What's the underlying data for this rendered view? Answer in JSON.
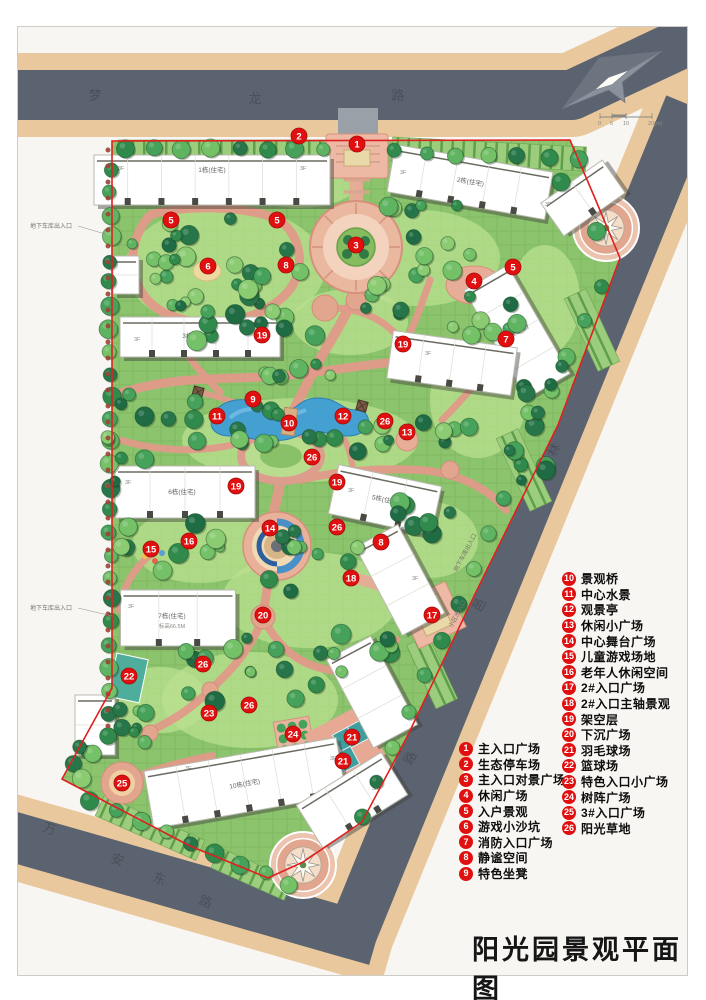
{
  "title": "阳光园景观平面图",
  "roads": [
    {
      "id": "menglong",
      "name": "梦龙路"
    },
    {
      "id": "linyi",
      "name": "林邑路"
    },
    {
      "id": "wanandong",
      "name": "万安东路"
    }
  ],
  "scale_bar": {
    "labels": [
      "0",
      "5",
      "10",
      "20(m)"
    ]
  },
  "legend": {
    "group_left": [
      {
        "num": "1",
        "label": "主入口广场"
      },
      {
        "num": "2",
        "label": "生态停车场"
      },
      {
        "num": "3",
        "label": "主入口对景广场"
      },
      {
        "num": "4",
        "label": "休闲广场"
      },
      {
        "num": "5",
        "label": "入户景观"
      },
      {
        "num": "6",
        "label": "游戏小沙坑"
      },
      {
        "num": "7",
        "label": "消防入口广场"
      },
      {
        "num": "8",
        "label": "静谧空间"
      },
      {
        "num": "9",
        "label": "特色坐凳"
      }
    ],
    "group_right": [
      {
        "num": "10",
        "label": "景观桥"
      },
      {
        "num": "11",
        "label": "中心水景"
      },
      {
        "num": "12",
        "label": "观景亭"
      },
      {
        "num": "13",
        "label": "休闲小广场"
      },
      {
        "num": "14",
        "label": "中心舞台广场"
      },
      {
        "num": "15",
        "label": "儿童游戏场地"
      },
      {
        "num": "16",
        "label": "老年人休闲空间"
      },
      {
        "num": "17",
        "label": "2#入口广场"
      },
      {
        "num": "18",
        "label": "2#入口主轴景观"
      },
      {
        "num": "19",
        "label": "架空层"
      },
      {
        "num": "20",
        "label": "下沉广场"
      },
      {
        "num": "21",
        "label": "羽毛球场"
      },
      {
        "num": "22",
        "label": "篮球场"
      },
      {
        "num": "23",
        "label": "特色入口小广场"
      },
      {
        "num": "24",
        "label": "树阵广场"
      },
      {
        "num": "25",
        "label": "3#入口广场"
      },
      {
        "num": "26",
        "label": "阳光草地"
      }
    ]
  },
  "plan_markers": [
    {
      "num": "1",
      "x": 357,
      "y": 144
    },
    {
      "num": "2",
      "x": 299,
      "y": 136
    },
    {
      "num": "3",
      "x": 356,
      "y": 245
    },
    {
      "num": "4",
      "x": 474,
      "y": 281
    },
    {
      "num": "5",
      "x": 171,
      "y": 220
    },
    {
      "num": "5",
      "x": 277,
      "y": 220
    },
    {
      "num": "5",
      "x": 513,
      "y": 267
    },
    {
      "num": "6",
      "x": 208,
      "y": 266
    },
    {
      "num": "7",
      "x": 506,
      "y": 339
    },
    {
      "num": "8",
      "x": 286,
      "y": 265
    },
    {
      "num": "8",
      "x": 381,
      "y": 542
    },
    {
      "num": "9",
      "x": 253,
      "y": 399
    },
    {
      "num": "10",
      "x": 289,
      "y": 423
    },
    {
      "num": "11",
      "x": 217,
      "y": 416
    },
    {
      "num": "12",
      "x": 343,
      "y": 416
    },
    {
      "num": "13",
      "x": 407,
      "y": 432
    },
    {
      "num": "14",
      "x": 270,
      "y": 528
    },
    {
      "num": "15",
      "x": 151,
      "y": 549
    },
    {
      "num": "16",
      "x": 189,
      "y": 541
    },
    {
      "num": "17",
      "x": 432,
      "y": 615
    },
    {
      "num": "18",
      "x": 351,
      "y": 578
    },
    {
      "num": "19",
      "x": 262,
      "y": 335
    },
    {
      "num": "19",
      "x": 403,
      "y": 344
    },
    {
      "num": "19",
      "x": 236,
      "y": 486
    },
    {
      "num": "19",
      "x": 337,
      "y": 482
    },
    {
      "num": "20",
      "x": 263,
      "y": 615
    },
    {
      "num": "21",
      "x": 352,
      "y": 737
    },
    {
      "num": "21",
      "x": 343,
      "y": 761
    },
    {
      "num": "22",
      "x": 129,
      "y": 676
    },
    {
      "num": "23",
      "x": 209,
      "y": 713
    },
    {
      "num": "24",
      "x": 293,
      "y": 734
    },
    {
      "num": "25",
      "x": 122,
      "y": 783
    },
    {
      "num": "26",
      "x": 385,
      "y": 421
    },
    {
      "num": "26",
      "x": 312,
      "y": 457
    },
    {
      "num": "26",
      "x": 337,
      "y": 527
    },
    {
      "num": "26",
      "x": 203,
      "y": 664
    },
    {
      "num": "26",
      "x": 249,
      "y": 705
    }
  ],
  "building_labels": [
    {
      "text": "1栋(住宅)",
      "x": 212,
      "y": 172,
      "rot": 0
    },
    {
      "text": "2栋(住宅)",
      "x": 470,
      "y": 184,
      "rot": 10
    },
    {
      "text": "3栋(住宅)",
      "x": 196,
      "y": 338,
      "rot": 0
    },
    {
      "text": "9栋(住宅)",
      "x": 517,
      "y": 334,
      "rot": -30
    },
    {
      "text": "6栋(住宅)",
      "x": 182,
      "y": 494,
      "rot": 0
    },
    {
      "text": "5栋(住宅)",
      "x": 385,
      "y": 502,
      "rot": 12
    },
    {
      "text": "7栋(住宅)",
      "x": 172,
      "y": 618,
      "rot": 0
    },
    {
      "text": "10栋(住宅)",
      "x": 245,
      "y": 786,
      "rot": -10
    }
  ],
  "floor_tag": "3F",
  "elevation_tag": "标高66.5M",
  "annotations": [
    {
      "text": "地下车库出入口",
      "x": 30,
      "y": 228,
      "rot": 0
    },
    {
      "text": "地下车库出入口",
      "x": 30,
      "y": 610,
      "rot": 0
    },
    {
      "text": "地下车库出入口",
      "x": 457,
      "y": 572,
      "rot": -62
    },
    {
      "text": "小区出入口",
      "x": 452,
      "y": 628,
      "rot": -62
    }
  ],
  "colors": {
    "marker_red": "#e01010",
    "boundary_red": "#e02020",
    "road": "#5c6370",
    "sidewalk": "#eac89d",
    "lawn": "#8cc46d",
    "path_salmon": "#e09a89",
    "plaza_salmon": "#e9b09a",
    "water": "#45a0d2",
    "building": "#ffffff",
    "court_teal": "#3f9f9f"
  }
}
